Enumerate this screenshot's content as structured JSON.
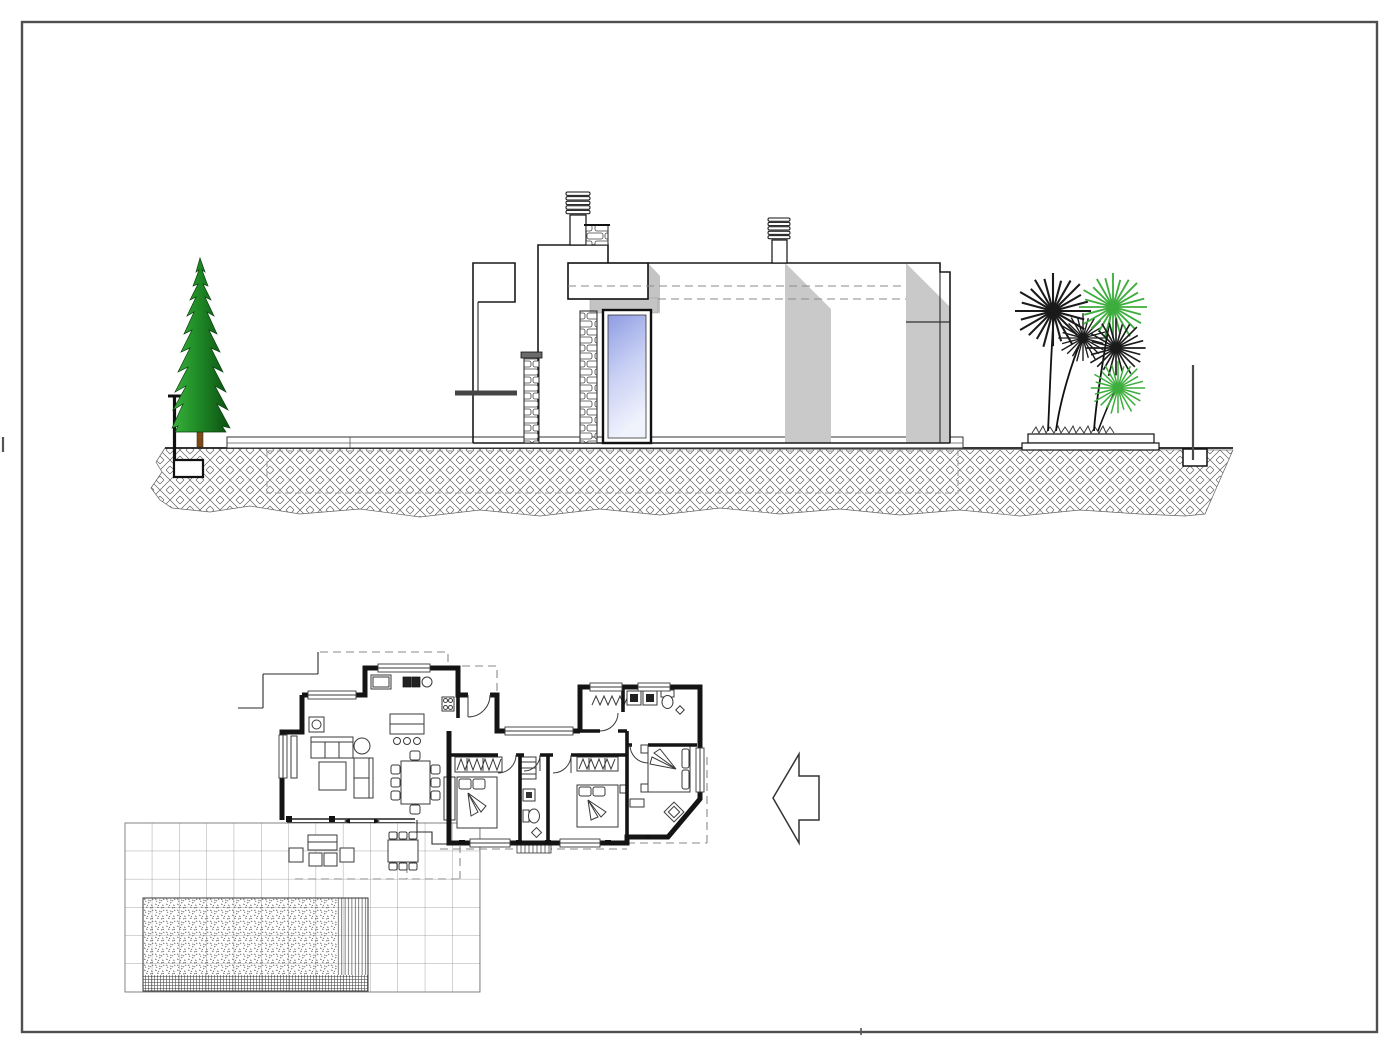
{
  "document": {
    "kind_label": "architectural-drawing-sheet",
    "elevation_label": "side elevation",
    "plan_label": "ground floor plan",
    "arrow_direction": "left"
  },
  "canvas": {
    "width": 1400,
    "height": 1056,
    "background": "#ffffff",
    "frame_color": "#4f4f4f"
  },
  "palette": {
    "line": "#1a1a1a",
    "shadow_gray": "#c9c9c9",
    "soffit_gray": "#c4c4c4",
    "ledge_gray": "#454545",
    "window_blue": "#8e9ce2",
    "window_blue_light": "#f0f2fc",
    "tree_green_light": "#39b23c",
    "tree_green_dark": "#0c4f12",
    "trunk_brown": "#7a4a1a",
    "palm_green": "#3dae3d",
    "palm_black": "#1a1a1a",
    "ground_hatch": "#5a5a5a",
    "terrace_grid": "#8a8a8a"
  },
  "elevation": {
    "aria_label": "Side elevation: flat-roof modern villa with stepped left facade, stone pillar, vertical blue glazed window, two corrugated roof vents, cast shadows, cypress tree on low retaining wall at left, palm planter and thin pole at right, on hatched ground with dashed foundation outline",
    "counts": {
      "cypress_trees": 1,
      "roof_vents": 2,
      "palm_heads": 5,
      "green_palm_heads": 2,
      "dark_palm_heads": 3,
      "poles": 1,
      "dashed_level_lines": 2
    }
  },
  "plan": {
    "aria_label": "Floor plan: open living-dining-kitchen with island and three stools, hallway, three bedrooms, two bathrooms, tiled terrace with outdoor lounge and dining sets, and rectangular pool with hatched water texture",
    "counts": {
      "beds": 3,
      "bathrooms": 2,
      "dining_chairs": 8,
      "bar_stools": 3,
      "sofa_seats": 5,
      "outdoor_dining_chairs": 6,
      "terrace_lounge_seats": 4,
      "closets_with_hangers": 2
    },
    "pool_present": true,
    "terrace_tiled": true
  }
}
